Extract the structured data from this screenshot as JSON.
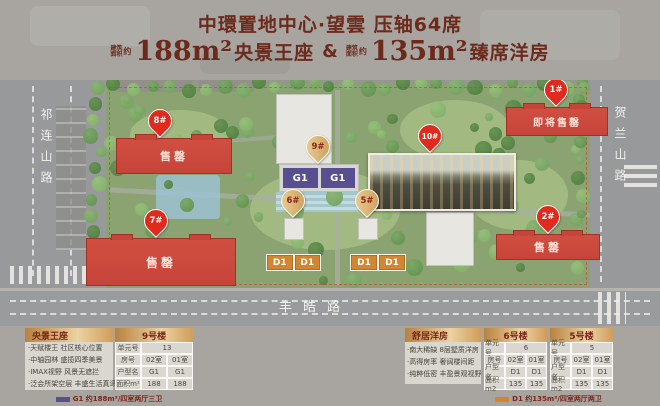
{
  "header": {
    "title": "中環置地中心·望雲 压轴64席",
    "note_line1": "建筑",
    "note_line2": "面积",
    "note_approx": "约",
    "area1": "188m²",
    "area1_name": "央景王座",
    "joiner": "&",
    "area2": "135m²",
    "area2_name": "臻席洋房"
  },
  "map": {
    "road_left": "祁连山路",
    "road_right": "贺兰山路",
    "road_bottom": "丰皓路",
    "pins": {
      "p1": "1#",
      "p2": "2#",
      "p5": "5#",
      "p6": "6#",
      "p7": "7#",
      "p8": "8#",
      "p9": "9#",
      "p10": "10#"
    },
    "status_sold": "售罄",
    "status_soon": "即将售罄",
    "unit_g1": "G1",
    "unit_d1": "D1"
  },
  "panels": {
    "left": {
      "title": "央景王座",
      "building": "9号楼",
      "bullets": [
        "·天赋楼王 社区核心位置",
        "·中轴园林 盛揽四季美景",
        "·IMAX视野 风景无遮拦",
        "·泛会所架空层 丰盛生活真谛"
      ],
      "unit_label": "单元号",
      "unit_value": "13",
      "room_label": "房号",
      "room_v1": "02室",
      "room_v2": "01室",
      "type_label": "户型名",
      "type_v1": "G1",
      "type_v2": "G1",
      "area_label": "面积m²",
      "area_v1": "188",
      "area_v2": "188",
      "legend": "G1 约188m²/四室两厅三卫"
    },
    "right": {
      "title": "舒居洋房",
      "bullets": [
        "·南大稀缺 8层墅质洋房",
        "·高得房率 奢阔楼间距",
        "·纯粹低密 丰盈景观视野"
      ],
      "t6": {
        "building": "6号楼",
        "unit_label": "单元号",
        "unit_value": "6",
        "room_label": "房号",
        "room_v1": "02室",
        "room_v2": "01室",
        "type_label": "户型名",
        "type_v1": "D1",
        "type_v2": "D1",
        "area_label": "面积m2",
        "area_v1": "135",
        "area_v2": "135"
      },
      "t5": {
        "building": "5号楼",
        "unit_label": "单元号",
        "unit_value": "5",
        "room_label": "房号",
        "room_v1": "02室",
        "room_v2": "01室",
        "type_label": "户型名",
        "type_v1": "D1",
        "type_v2": "D1",
        "area_label": "面积m2",
        "area_v1": "135",
        "area_v2": "135"
      },
      "legend": "D1 约135m²/四室两厅两卫"
    }
  }
}
